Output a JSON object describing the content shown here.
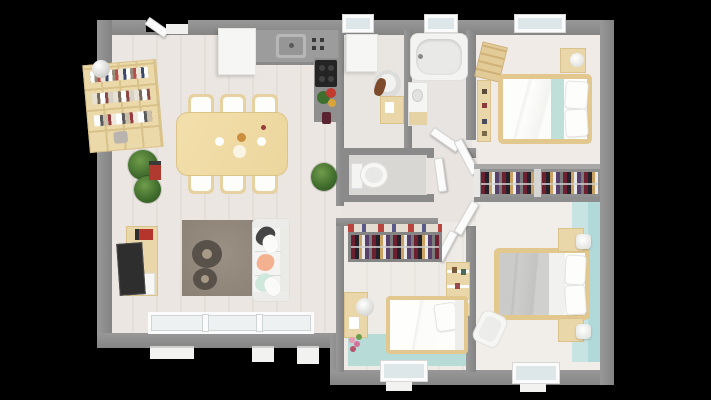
{
  "scene": {
    "type": "3d-floor-plan-top-view",
    "description": "Top-down 3D architectural render of a single-storey house interior on a black background",
    "background_color": "#000000"
  },
  "palette": {
    "wall_gray": "#8e8e8e",
    "floor_light": "#ebe6e1",
    "floor_bath_gray": "#d9d7d4",
    "teal_accent": "#b2d9da",
    "teal_floor": "#b7dbd7",
    "wood_light": "#ead7a8",
    "bed_frame_wood": "#e2c88e",
    "kitchen_counter": "#9c9c9c",
    "cooktop_black": "#242424",
    "rug_taupe": "#93887c",
    "sofa_white": "#f4f4f2",
    "cushion_dark": "#454545",
    "cushion_peach": "#f4b190",
    "cushion_mint": "#cfe8dc",
    "duvet_gray": "#c9c9c7",
    "plant_green": "#3f6b2c",
    "accent_red": "#b03a30"
  },
  "rooms": [
    {
      "id": "living-dining-kitchen",
      "position": "left",
      "furniture": [
        "wall-bookshelf-with-books",
        "ball-lamp",
        "dining-table",
        "dining-chairs-x6",
        "potted-plants",
        "red-decor-item",
        "kitchen-tall-cabinet",
        "kitchen-counter-with-sink",
        "cooktop",
        "counter-flowers",
        "tv-console",
        "tv",
        "area-rug",
        "round-poufs-x2",
        "sofa-with-cushions",
        "sliding-glass-windows"
      ]
    },
    {
      "id": "utility-office",
      "position": "top-middle",
      "furniture": [
        "washing-machine",
        "desk-chair",
        "small-desk"
      ]
    },
    {
      "id": "bathroom",
      "position": "top-middle-right",
      "furniture": [
        "bathtub",
        "vanity-with-sink",
        "door"
      ]
    },
    {
      "id": "wc",
      "position": "middle",
      "furniture": [
        "toilet"
      ]
    },
    {
      "id": "hallway",
      "position": "center-right",
      "furniture": [
        "interior-door-leaves-x5",
        "potted-plant"
      ]
    },
    {
      "id": "bedroom-top-right",
      "furniture": [
        "double-bed-with-teal-runner",
        "nightstand-with-lamp",
        "ladder-shelf",
        "narrow-shelf",
        "open-wardrobe-with-clothes",
        "window"
      ]
    },
    {
      "id": "bedroom-bottom-middle",
      "furniture": [
        "single-bed",
        "open-wardrobe-with-clothes",
        "desk-with-lamp",
        "tall-shelf",
        "pink-flowers",
        "teal-floor-accent",
        "window"
      ]
    },
    {
      "id": "bedroom-bottom-right",
      "furniture": [
        "double-bed-gray-duvet",
        "nightstand-with-lamp-x2",
        "side-chair",
        "teal-accent-wall",
        "window"
      ]
    }
  ],
  "openings": {
    "entrance_door": "top wall, left of kitchen",
    "top_wall_windows": 3,
    "bottom_wall_windows": "living sliding glazing + 2 bedroom windows"
  }
}
